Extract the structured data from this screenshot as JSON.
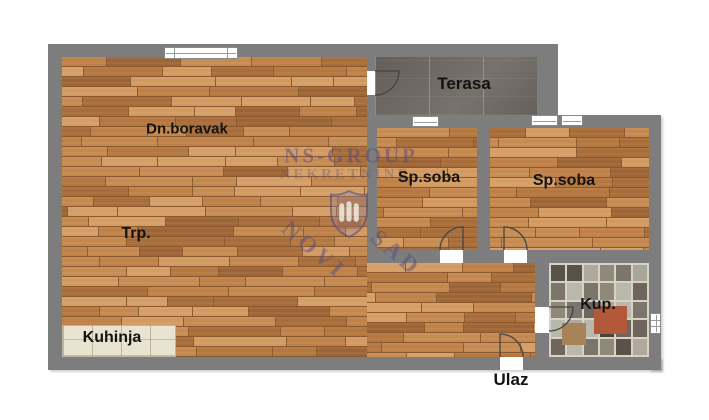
{
  "floorplan": {
    "rooms": {
      "living": "Dn.boravak",
      "terrace": "Terasa",
      "bedroom1": "Sp.soba",
      "bedroom2": "Sp.soba",
      "dining": "Trp.",
      "kitchen": "Kuhinja",
      "bathroom": "Kup.",
      "entrance": "Ulaz"
    },
    "watermark": {
      "line1": "NS-GROUP",
      "line2": "NEKRETNINE",
      "word1": "NOVI",
      "word2": "SAD"
    },
    "colors": {
      "wall": "#7d7d7d",
      "wood_base": "#c08148",
      "terrace_tile": "#6f6963",
      "kitchen_tile": "#e9e3d1",
      "bath_grout": "#d6d3c6",
      "bath_accent_red": "#b2583b",
      "watermark": "#5d4a7a",
      "background": "#ffffff"
    }
  }
}
